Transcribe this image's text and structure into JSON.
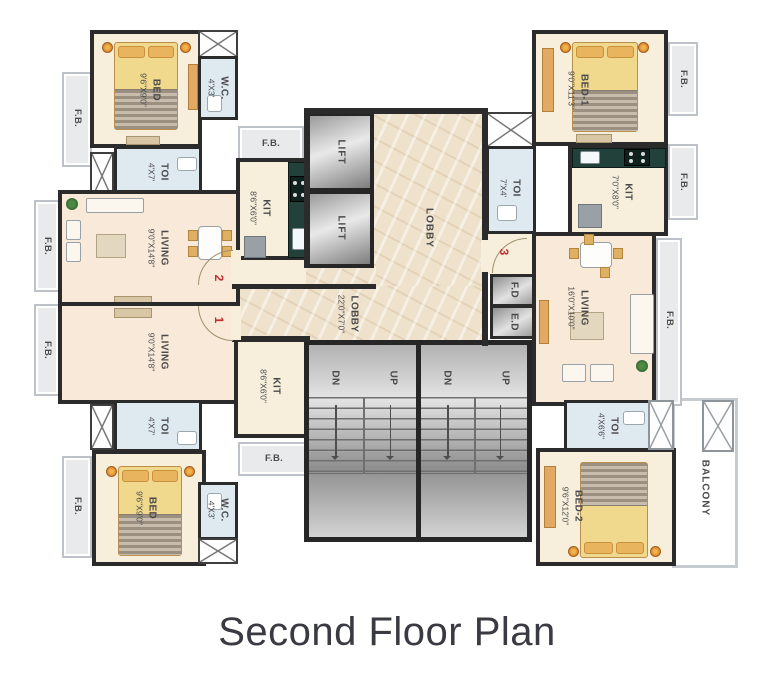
{
  "title": "Second Floor Plan",
  "labels": {
    "fb": "F.B.",
    "fd": "F.D",
    "ed": "E.D",
    "lift": "LIFT",
    "lobby": "LOBBY",
    "lobby_dims": "22'0\"X7'0\"",
    "dn": "DN",
    "up": "UP",
    "balcony": "BALCONY"
  },
  "flat_numbers": {
    "one": "1",
    "two": "2",
    "three": "3"
  },
  "rooms": {
    "bed_tl": {
      "name": "BED",
      "dims": "9'6\"X9'0\""
    },
    "wc_tl": {
      "name": "W.C.",
      "dims": "4'X3'"
    },
    "toi_tl": {
      "name": "TOI",
      "dims": "4'X7'"
    },
    "kit_tl": {
      "name": "KIT",
      "dims": "8'6\"X6'0\""
    },
    "living_flat2": {
      "name": "LIVING",
      "dims": "9'0\"X14'8\""
    },
    "living_flat1": {
      "name": "LIVING",
      "dims": "9'0\"X14'8\""
    },
    "kit_bl": {
      "name": "KIT",
      "dims": "8'6\"X6'0\""
    },
    "toi_bl": {
      "name": "TOI",
      "dims": "4'X7'"
    },
    "bed_bl": {
      "name": "BED",
      "dims": "9'6\"X9'0\""
    },
    "wc_bl": {
      "name": "W.C.",
      "dims": "4'X3'"
    },
    "bed1_tr": {
      "name": "BED-1",
      "dims": "9'0\"X11'3\""
    },
    "kit_tr": {
      "name": "KIT",
      "dims": "7'0\"X8'0\""
    },
    "toi_tr": {
      "name": "TOI",
      "dims": "7'X4'"
    },
    "living_flat3": {
      "name": "LIVING",
      "dims": "16'0\"X10'0\""
    },
    "toi_br": {
      "name": "TOI",
      "dims": "4'X6'6\""
    },
    "bed2_br": {
      "name": "BED-2",
      "dims": "9'6\"X12'0\""
    }
  }
}
